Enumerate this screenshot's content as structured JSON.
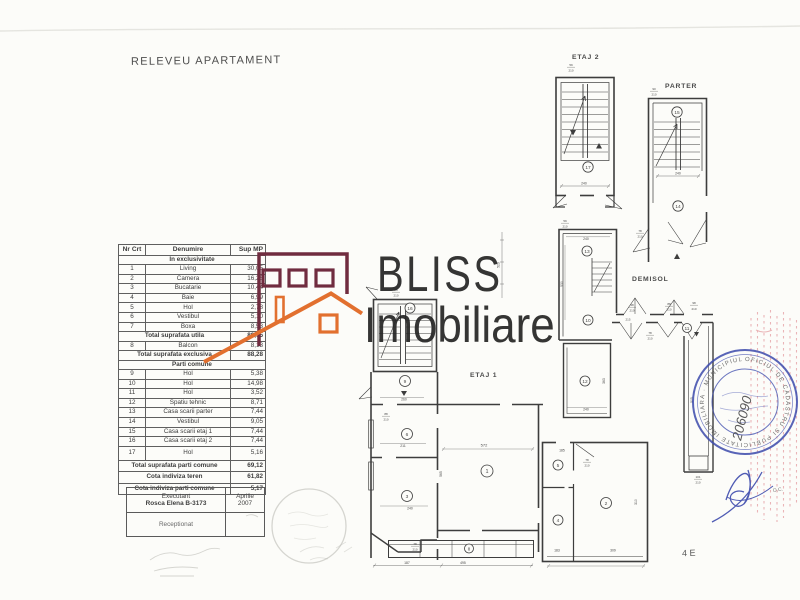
{
  "page": {
    "title": "RELEVEU APARTAMENT",
    "page_mark": "4 E"
  },
  "table": {
    "headers": [
      "Nr Crt",
      "Denumire",
      "Sup MP"
    ],
    "sections": {
      "exclusive": "In exclusivitate",
      "common": "Parti comune"
    },
    "rows_exclusive": [
      {
        "no": "1",
        "name": "Living",
        "area": "30,05"
      },
      {
        "no": "2",
        "name": "Camera",
        "area": "16,26"
      },
      {
        "no": "3",
        "name": "Bucatarie",
        "area": "10,44"
      },
      {
        "no": "4",
        "name": "Baie",
        "area": "6,99"
      },
      {
        "no": "5",
        "name": "Hol",
        "area": "2,78"
      },
      {
        "no": "6",
        "name": "Vestibul",
        "area": "5,10"
      },
      {
        "no": "7",
        "name": "Boxa",
        "area": "8,53"
      }
    ],
    "total_utila": {
      "label": "Total suprafata utila",
      "area": "80,15"
    },
    "row_balcon": {
      "no": "8",
      "name": "Balcon",
      "area": "8,13"
    },
    "total_exclusiva": {
      "label": "Total suprafata exclusiva",
      "area": "88,28"
    },
    "rows_common": [
      {
        "no": "9",
        "name": "Hol",
        "area": "5,38"
      },
      {
        "no": "10",
        "name": "Hol",
        "area": "14,98"
      },
      {
        "no": "11",
        "name": "Hol",
        "area": "3,52"
      },
      {
        "no": "12",
        "name": "Spatiu tehnic",
        "area": "8,71"
      },
      {
        "no": "13",
        "name": "Casa scarii parter",
        "area": "7,44"
      },
      {
        "no": "14",
        "name": "Vestibul",
        "area": "9,05"
      },
      {
        "no": "15",
        "name": "Casa scarii etaj 1",
        "area": "7,44"
      },
      {
        "no": "16",
        "name": "Casa scarii etaj 2",
        "area": "7,44"
      },
      {
        "no": "17",
        "name": "Hol",
        "area": "5,16"
      }
    ],
    "total_comune": {
      "label": "Total suprafata parti comune",
      "area": "69,12"
    },
    "cota_teren": {
      "label": "Cota indiviza teren",
      "area": "61,82"
    },
    "cota_parti": {
      "label": "Cota indiviza parti comune",
      "area": "5,17"
    }
  },
  "signature_box": {
    "executant_label": "Executant",
    "executant_name": "Rosca Elena  B-3173",
    "date_line1": "Aprilie",
    "date_line2": "2007",
    "receptionat_label": "Receptionat"
  },
  "logo": {
    "brand_top": "BLISS",
    "brand_bottom": "Imobiliare",
    "maroon": "#702c3f",
    "orange": "#e2702f",
    "text_color": "#262626"
  },
  "plans": {
    "labels": {
      "etaj2": "ETAJ 2",
      "parter": "PARTER",
      "demisol": "DEMISOL",
      "etaj1": "ETAJ 1"
    },
    "rooms": {
      "n1": "1",
      "n2": "2",
      "n3": "3",
      "n4": "4",
      "n5": "5",
      "n6": "6",
      "n8": "8",
      "n9": "9",
      "n10": "10",
      "n11": "11",
      "n12": "12",
      "n13": "13",
      "n14": "14",
      "n15": "15",
      "n16": "16",
      "n17": "17"
    },
    "dims": {
      "d240": "240",
      "d530": "530",
      "d363": "363",
      "d505": "505",
      "d572": "572",
      "d565": "565",
      "d495": "495",
      "d187": "187",
      "d260": "260",
      "d211": "211",
      "d310": "310",
      "d309": "309",
      "d183": "183",
      "d185": "185",
      "d215": "215",
      "d523": "523",
      "d28": "28",
      "d59": "59",
      "d210": "210",
      "d90": "90",
      "d88": "88",
      "d78": "78",
      "d48": "48",
      "d98": "98",
      "d101": "101"
    }
  },
  "stamps": {
    "blue_color": "#3b49ac",
    "ring_text": "OFICIUL DE CADASTRU SI PUBLICITATE IMOBILIARA · MUNICIPIUL BUCURESTI ·",
    "registration_number": "206090",
    "red_color": "#d97078",
    "red_fragment": "O.C.",
    "pencil_color": "#c6c6c0"
  }
}
